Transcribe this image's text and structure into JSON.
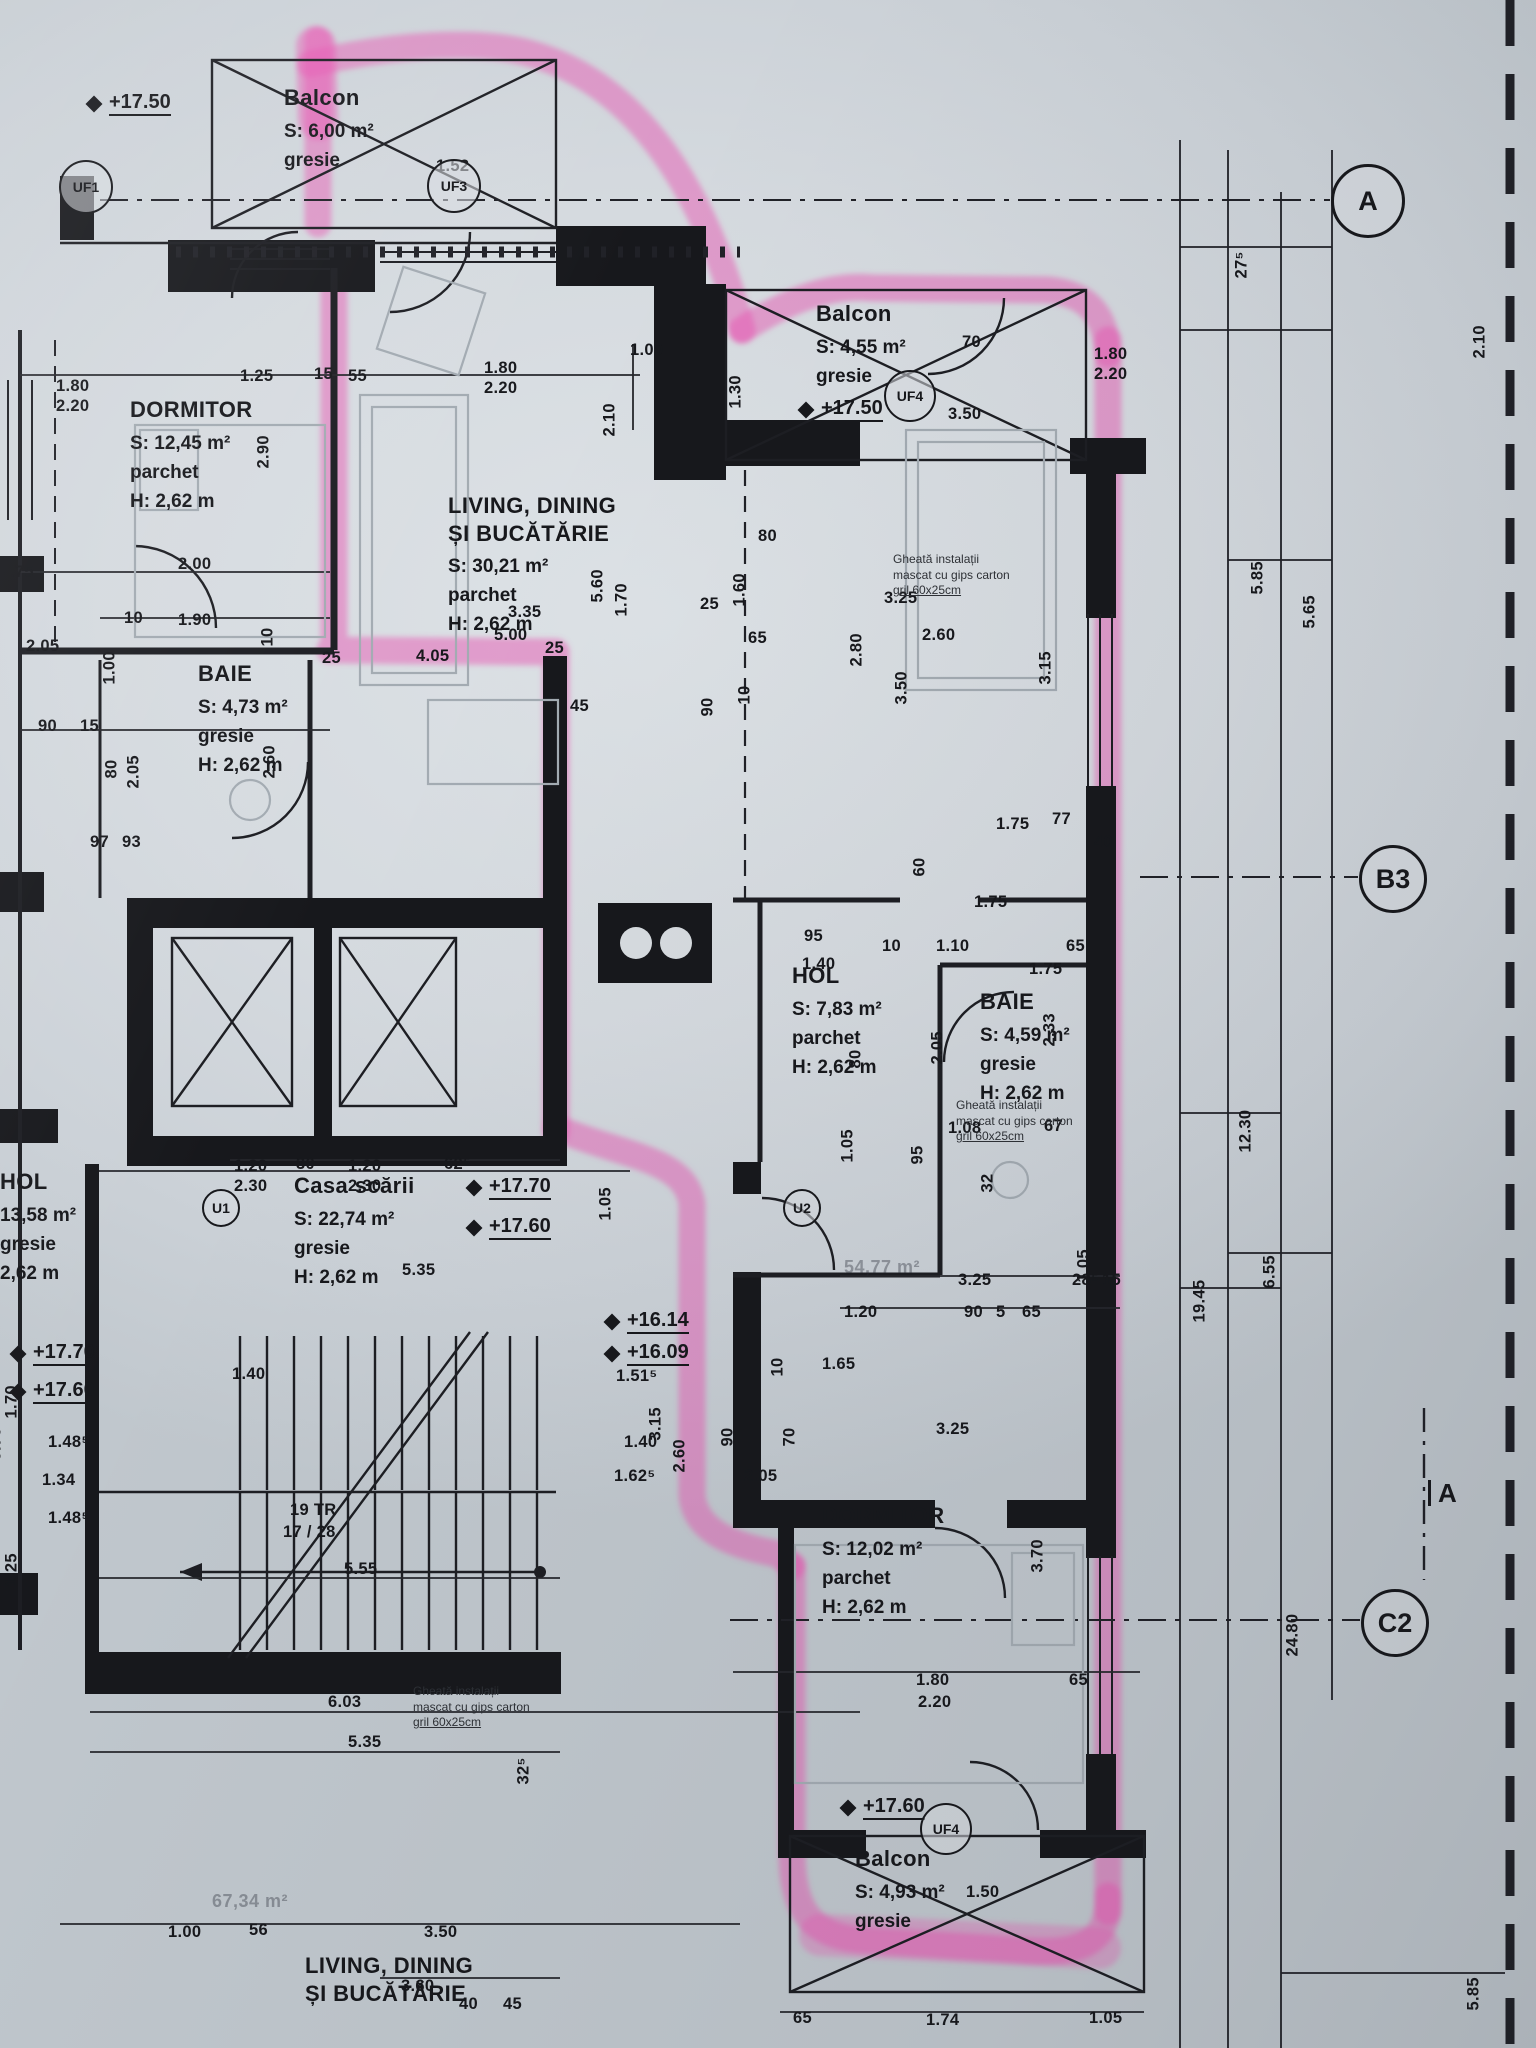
{
  "plan": {
    "palette": {
      "paper": "#d6dbdf",
      "ink": "#17181c",
      "highlight": "#e75ab4",
      "furniture": "#a3abb2"
    },
    "highlighted_apartment_total": "54,77 m²",
    "rooms": [
      {
        "x": 284,
        "y": 84,
        "name_lines": [
          "Balcon"
        ],
        "details": [
          "S: 6,00 m²",
          "gresie"
        ]
      },
      {
        "x": 130,
        "y": 396,
        "name_lines": [
          "DORMITOR"
        ],
        "details": [
          "S: 12,45 m²",
          "parchet",
          "H: 2,62 m"
        ]
      },
      {
        "x": 448,
        "y": 492,
        "name_lines": [
          "LIVING, DINING",
          "ȘI BUCĂTĂRIE"
        ],
        "details": [
          "S: 30,21 m²",
          "parchet",
          "H: 2,62 m"
        ]
      },
      {
        "x": 198,
        "y": 660,
        "name_lines": [
          "BAIE"
        ],
        "details": [
          "S: 4,73 m²",
          "gresie",
          "H: 2,62 m"
        ]
      },
      {
        "x": 816,
        "y": 300,
        "name_lines": [
          "Balcon"
        ],
        "details": [
          "S: 4,55 m²",
          "gresie"
        ]
      },
      {
        "x": 792,
        "y": 962,
        "name_lines": [
          "HOL"
        ],
        "details": [
          "S: 7,83 m²",
          "parchet",
          "H: 2,62 m"
        ]
      },
      {
        "x": 980,
        "y": 988,
        "name_lines": [
          "BAIE"
        ],
        "details": [
          "S: 4,59 m²",
          "gresie",
          "H: 2,62 m"
        ]
      },
      {
        "x": 294,
        "y": 1172,
        "name_lines": [
          "Casa scării"
        ],
        "details": [
          "S: 22,74 m²",
          "gresie",
          "H: 2,62 m"
        ]
      },
      {
        "x": 822,
        "y": 1502,
        "name_lines": [
          "DORMITOR"
        ],
        "details": [
          "S: 12,02 m²",
          "parchet",
          "H: 2,62 m"
        ]
      },
      {
        "x": 855,
        "y": 1845,
        "name_lines": [
          "Balcon"
        ],
        "details": [
          "S: 4,93 m²",
          "gresie"
        ]
      },
      {
        "x": 0,
        "y": 1168,
        "name_lines": [
          "HOL"
        ],
        "details": [
          "13,58 m²",
          "gresie",
          "2,62 m"
        ]
      },
      {
        "x": 305,
        "y": 1952,
        "name_lines": [
          "LIVING, DINING",
          "ȘI BUCĂTĂRIE"
        ],
        "details": []
      }
    ],
    "levels": [
      {
        "t": "+17.50",
        "x": 88,
        "y": 92
      },
      {
        "t": "+17.50",
        "x": 800,
        "y": 398
      },
      {
        "t": "+17.70",
        "x": 468,
        "y": 1176
      },
      {
        "t": "+17.60",
        "x": 468,
        "y": 1216
      },
      {
        "t": "+16.14",
        "x": 606,
        "y": 1310
      },
      {
        "t": "+16.09",
        "x": 606,
        "y": 1342
      },
      {
        "t": "+17.60",
        "x": 842,
        "y": 1796
      },
      {
        "t": "+17.70",
        "x": 12,
        "y": 1342
      },
      {
        "t": "+17.60",
        "x": 12,
        "y": 1380
      }
    ],
    "notes": [
      {
        "x": 893,
        "y": 552,
        "lines": [
          "Gheată instalații",
          "mascat cu gips carton",
          "gril 60x25cm"
        ]
      },
      {
        "x": 956,
        "y": 1098,
        "lines": [
          "Gheată instalații",
          "mascat cu gips carton",
          "gril 60x25cm"
        ]
      },
      {
        "x": 413,
        "y": 1684,
        "lines": [
          "Gheată instalații",
          "mascat cu gips carton",
          "gril 60x25cm"
        ]
      }
    ],
    "door_tags": [
      {
        "t": "UF1",
        "x": 84,
        "y": 185,
        "r": 25
      },
      {
        "t": "UF3",
        "x": 452,
        "y": 184,
        "r": 25
      },
      {
        "t": "UF4",
        "x": 908,
        "y": 394,
        "r": 24
      },
      {
        "t": "UF4",
        "x": 944,
        "y": 1827,
        "r": 24
      },
      {
        "t": "U1",
        "x": 219,
        "y": 1206,
        "r": 17
      },
      {
        "t": "U2",
        "x": 800,
        "y": 1206,
        "r": 17
      }
    ],
    "grid": {
      "circles": [
        {
          "t": "A",
          "x": 1365,
          "y": 198,
          "r": 34
        },
        {
          "t": "B3",
          "x": 1390,
          "y": 876,
          "r": 31
        },
        {
          "t": "C2",
          "x": 1392,
          "y": 1620,
          "r": 31
        }
      ],
      "section": {
        "t": "A",
        "x": 1428,
        "y": 1480
      }
    },
    "annotations": [
      {
        "t": "54,77 m²",
        "x": 844,
        "y": 1258
      },
      {
        "t": "67,34 m²",
        "x": 212,
        "y": 1892
      }
    ],
    "dims": [
      {
        "t": "1.80",
        "x": 56,
        "y": 378
      },
      {
        "t": "2.20",
        "x": 56,
        "y": 398
      },
      {
        "t": "1.25",
        "x": 240,
        "y": 368
      },
      {
        "t": "15",
        "x": 314,
        "y": 366
      },
      {
        "t": "55",
        "x": 348,
        "y": 368
      },
      {
        "t": "1.80",
        "x": 484,
        "y": 360
      },
      {
        "t": "2.20",
        "x": 484,
        "y": 380
      },
      {
        "t": "1.52",
        "x": 436,
        "y": 158
      },
      {
        "t": "2.90",
        "x": 272,
        "y": 452,
        "r": 1
      },
      {
        "t": "1.00",
        "x": 630,
        "y": 342
      },
      {
        "t": "2.10",
        "x": 618,
        "y": 420,
        "r": 1
      },
      {
        "t": "1.30",
        "x": 744,
        "y": 392,
        "r": 1
      },
      {
        "t": "3.50",
        "x": 948,
        "y": 406
      },
      {
        "t": "70",
        "x": 962,
        "y": 334
      },
      {
        "t": "1.80",
        "x": 1094,
        "y": 346
      },
      {
        "t": "2.20",
        "x": 1094,
        "y": 366
      },
      {
        "t": "27⁵",
        "x": 1250,
        "y": 262,
        "r": 1
      },
      {
        "t": "2.10",
        "x": 1488,
        "y": 342,
        "r": 1
      },
      {
        "t": "2.00",
        "x": 178,
        "y": 556
      },
      {
        "t": ".75",
        "x": 10,
        "y": 564
      },
      {
        "t": "2.05",
        "x": 26,
        "y": 638
      },
      {
        "t": "1.90",
        "x": 178,
        "y": 612
      },
      {
        "t": "10",
        "x": 124,
        "y": 610
      },
      {
        "t": "25",
        "x": 322,
        "y": 650
      },
      {
        "t": "10",
        "x": 276,
        "y": 630,
        "r": 1
      },
      {
        "t": "1.00",
        "x": 118,
        "y": 668,
        "r": 1
      },
      {
        "t": "2.60",
        "x": 278,
        "y": 762,
        "r": 1
      },
      {
        "t": "90",
        "x": 38,
        "y": 718
      },
      {
        "t": "15",
        "x": 80,
        "y": 718
      },
      {
        "t": "80",
        "x": 120,
        "y": 762,
        "r": 1
      },
      {
        "t": "2.05",
        "x": 142,
        "y": 772,
        "r": 1
      },
      {
        "t": "97",
        "x": 90,
        "y": 834
      },
      {
        "t": "93",
        "x": 122,
        "y": 834
      },
      {
        "t": "5.60",
        "x": 606,
        "y": 586,
        "r": 1
      },
      {
        "t": "1.70",
        "x": 630,
        "y": 600,
        "r": 1
      },
      {
        "t": "3.35",
        "x": 508,
        "y": 604
      },
      {
        "t": "5.00",
        "x": 494,
        "y": 627
      },
      {
        "t": "4.05",
        "x": 416,
        "y": 648
      },
      {
        "t": "25",
        "x": 545,
        "y": 640
      },
      {
        "t": "45",
        "x": 570,
        "y": 698
      },
      {
        "t": "80",
        "x": 758,
        "y": 528
      },
      {
        "t": "1.60",
        "x": 748,
        "y": 590,
        "r": 1
      },
      {
        "t": "25",
        "x": 700,
        "y": 596
      },
      {
        "t": "65",
        "x": 748,
        "y": 630
      },
      {
        "t": "90",
        "x": 716,
        "y": 700,
        "r": 1
      },
      {
        "t": "10",
        "x": 753,
        "y": 688,
        "r": 1
      },
      {
        "t": "3.25",
        "x": 884,
        "y": 590
      },
      {
        "t": "2.80",
        "x": 865,
        "y": 650,
        "r": 1
      },
      {
        "t": "2.60",
        "x": 922,
        "y": 627
      },
      {
        "t": "3.50",
        "x": 910,
        "y": 688,
        "r": 1
      },
      {
        "t": "3.15",
        "x": 1054,
        "y": 668,
        "r": 1
      },
      {
        "t": "1.75",
        "x": 996,
        "y": 816
      },
      {
        "t": "77",
        "x": 1052,
        "y": 811
      },
      {
        "t": "40",
        "x": 1094,
        "y": 834
      },
      {
        "t": "60",
        "x": 928,
        "y": 860,
        "r": 1
      },
      {
        "t": "1.75",
        "x": 974,
        "y": 894
      },
      {
        "t": "95",
        "x": 804,
        "y": 928
      },
      {
        "t": "1.40",
        "x": 802,
        "y": 956
      },
      {
        "t": "10",
        "x": 882,
        "y": 938
      },
      {
        "t": "1.10",
        "x": 936,
        "y": 938
      },
      {
        "t": "65",
        "x": 1066,
        "y": 938
      },
      {
        "t": "1.75",
        "x": 1029,
        "y": 961
      },
      {
        "t": "2.33",
        "x": 1058,
        "y": 1030,
        "r": 1
      },
      {
        "t": "2.05",
        "x": 946,
        "y": 1048,
        "r": 1
      },
      {
        "t": "80",
        "x": 864,
        "y": 1052,
        "r": 1
      },
      {
        "t": "1.05",
        "x": 856,
        "y": 1146,
        "r": 1
      },
      {
        "t": "95",
        "x": 926,
        "y": 1148,
        "r": 1
      },
      {
        "t": "1.08",
        "x": 948,
        "y": 1120
      },
      {
        "t": "67",
        "x": 1044,
        "y": 1118
      },
      {
        "t": "32",
        "x": 996,
        "y": 1176,
        "r": 1
      },
      {
        "t": "3.25",
        "x": 958,
        "y": 1272
      },
      {
        "t": "28⁵",
        "x": 1072,
        "y": 1272
      },
      {
        "t": "15",
        "x": 1102,
        "y": 1272
      },
      {
        "t": "1.20",
        "x": 844,
        "y": 1304
      },
      {
        "t": "90",
        "x": 964,
        "y": 1304
      },
      {
        "t": "5",
        "x": 996,
        "y": 1304
      },
      {
        "t": "65",
        "x": 1022,
        "y": 1304
      },
      {
        "t": "1.05",
        "x": 1092,
        "y": 1266,
        "r": 1
      },
      {
        "t": "5.35",
        "x": 402,
        "y": 1262
      },
      {
        "t": "1.05",
        "x": 614,
        "y": 1204,
        "r": 1
      },
      {
        "t": "1.20",
        "x": 234,
        "y": 1158
      },
      {
        "t": "2.30",
        "x": 234,
        "y": 1178
      },
      {
        "t": "30",
        "x": 296,
        "y": 1156
      },
      {
        "t": "1.20",
        "x": 348,
        "y": 1158
      },
      {
        "t": "2.30",
        "x": 348,
        "y": 1178
      },
      {
        "t": "62⁵",
        "x": 444,
        "y": 1156
      },
      {
        "t": "1.51⁵",
        "x": 616,
        "y": 1368
      },
      {
        "t": "1.62⁵",
        "x": 614,
        "y": 1468
      },
      {
        "t": "3.15",
        "x": 664,
        "y": 1424,
        "r": 1
      },
      {
        "t": "2.60",
        "x": 688,
        "y": 1456,
        "r": 1
      },
      {
        "t": "1.40",
        "x": 624,
        "y": 1434
      },
      {
        "t": "19 TR",
        "x": 290,
        "y": 1502
      },
      {
        "t": "17 / 28",
        "x": 283,
        "y": 1524
      },
      {
        "t": "5.55",
        "x": 344,
        "y": 1561
      },
      {
        "t": "1.40",
        "x": 232,
        "y": 1366
      },
      {
        "t": "1.70",
        "x": 20,
        "y": 1402,
        "r": 1
      },
      {
        "t": "1.48⁵",
        "x": 48,
        "y": 1434
      },
      {
        "t": "1.34",
        "x": 42,
        "y": 1472
      },
      {
        "t": "1.48⁵",
        "x": 48,
        "y": 1510
      },
      {
        "t": "1.25",
        "x": 20,
        "y": 1570,
        "r": 1
      },
      {
        "t": "9.70",
        "x": 4,
        "y": 1444,
        "r": 1
      },
      {
        "t": "1.65",
        "x": 822,
        "y": 1356
      },
      {
        "t": "10",
        "x": 786,
        "y": 1360,
        "r": 1
      },
      {
        "t": "90",
        "x": 736,
        "y": 1430,
        "r": 1
      },
      {
        "t": "70",
        "x": 798,
        "y": 1430,
        "r": 1
      },
      {
        "t": "2.05",
        "x": 744,
        "y": 1468
      },
      {
        "t": "3.25",
        "x": 936,
        "y": 1421
      },
      {
        "t": "3.70",
        "x": 1046,
        "y": 1556,
        "r": 1
      },
      {
        "t": "1.80",
        "x": 916,
        "y": 1672
      },
      {
        "t": "2.20",
        "x": 918,
        "y": 1694
      },
      {
        "t": "65",
        "x": 1069,
        "y": 1672
      },
      {
        "t": "1.50",
        "x": 966,
        "y": 1884
      },
      {
        "t": "65",
        "x": 793,
        "y": 2010
      },
      {
        "t": "1.74",
        "x": 926,
        "y": 2012
      },
      {
        "t": "1.05",
        "x": 1089,
        "y": 2010
      },
      {
        "t": "6.03",
        "x": 328,
        "y": 1694
      },
      {
        "t": "5.35",
        "x": 348,
        "y": 1734
      },
      {
        "t": "32⁵",
        "x": 532,
        "y": 1768,
        "r": 1
      },
      {
        "t": "3.60",
        "x": 401,
        "y": 1978
      },
      {
        "t": "1.00",
        "x": 168,
        "y": 1924
      },
      {
        "t": "56",
        "x": 249,
        "y": 1922
      },
      {
        "t": "3.50",
        "x": 424,
        "y": 1924
      },
      {
        "t": "40",
        "x": 459,
        "y": 1996
      },
      {
        "t": "45",
        "x": 503,
        "y": 1996
      },
      {
        "t": "5.85",
        "x": 1266,
        "y": 578,
        "r": 1
      },
      {
        "t": "5.65",
        "x": 1318,
        "y": 612,
        "r": 1
      },
      {
        "t": "12.30",
        "x": 1254,
        "y": 1136,
        "r": 1
      },
      {
        "t": "6.55",
        "x": 1278,
        "y": 1272,
        "r": 1
      },
      {
        "t": "19.45",
        "x": 1208,
        "y": 1306,
        "r": 1
      },
      {
        "t": "24.80",
        "x": 1301,
        "y": 1640,
        "r": 1
      },
      {
        "t": "5.85",
        "x": 1482,
        "y": 1994,
        "r": 1
      }
    ]
  }
}
